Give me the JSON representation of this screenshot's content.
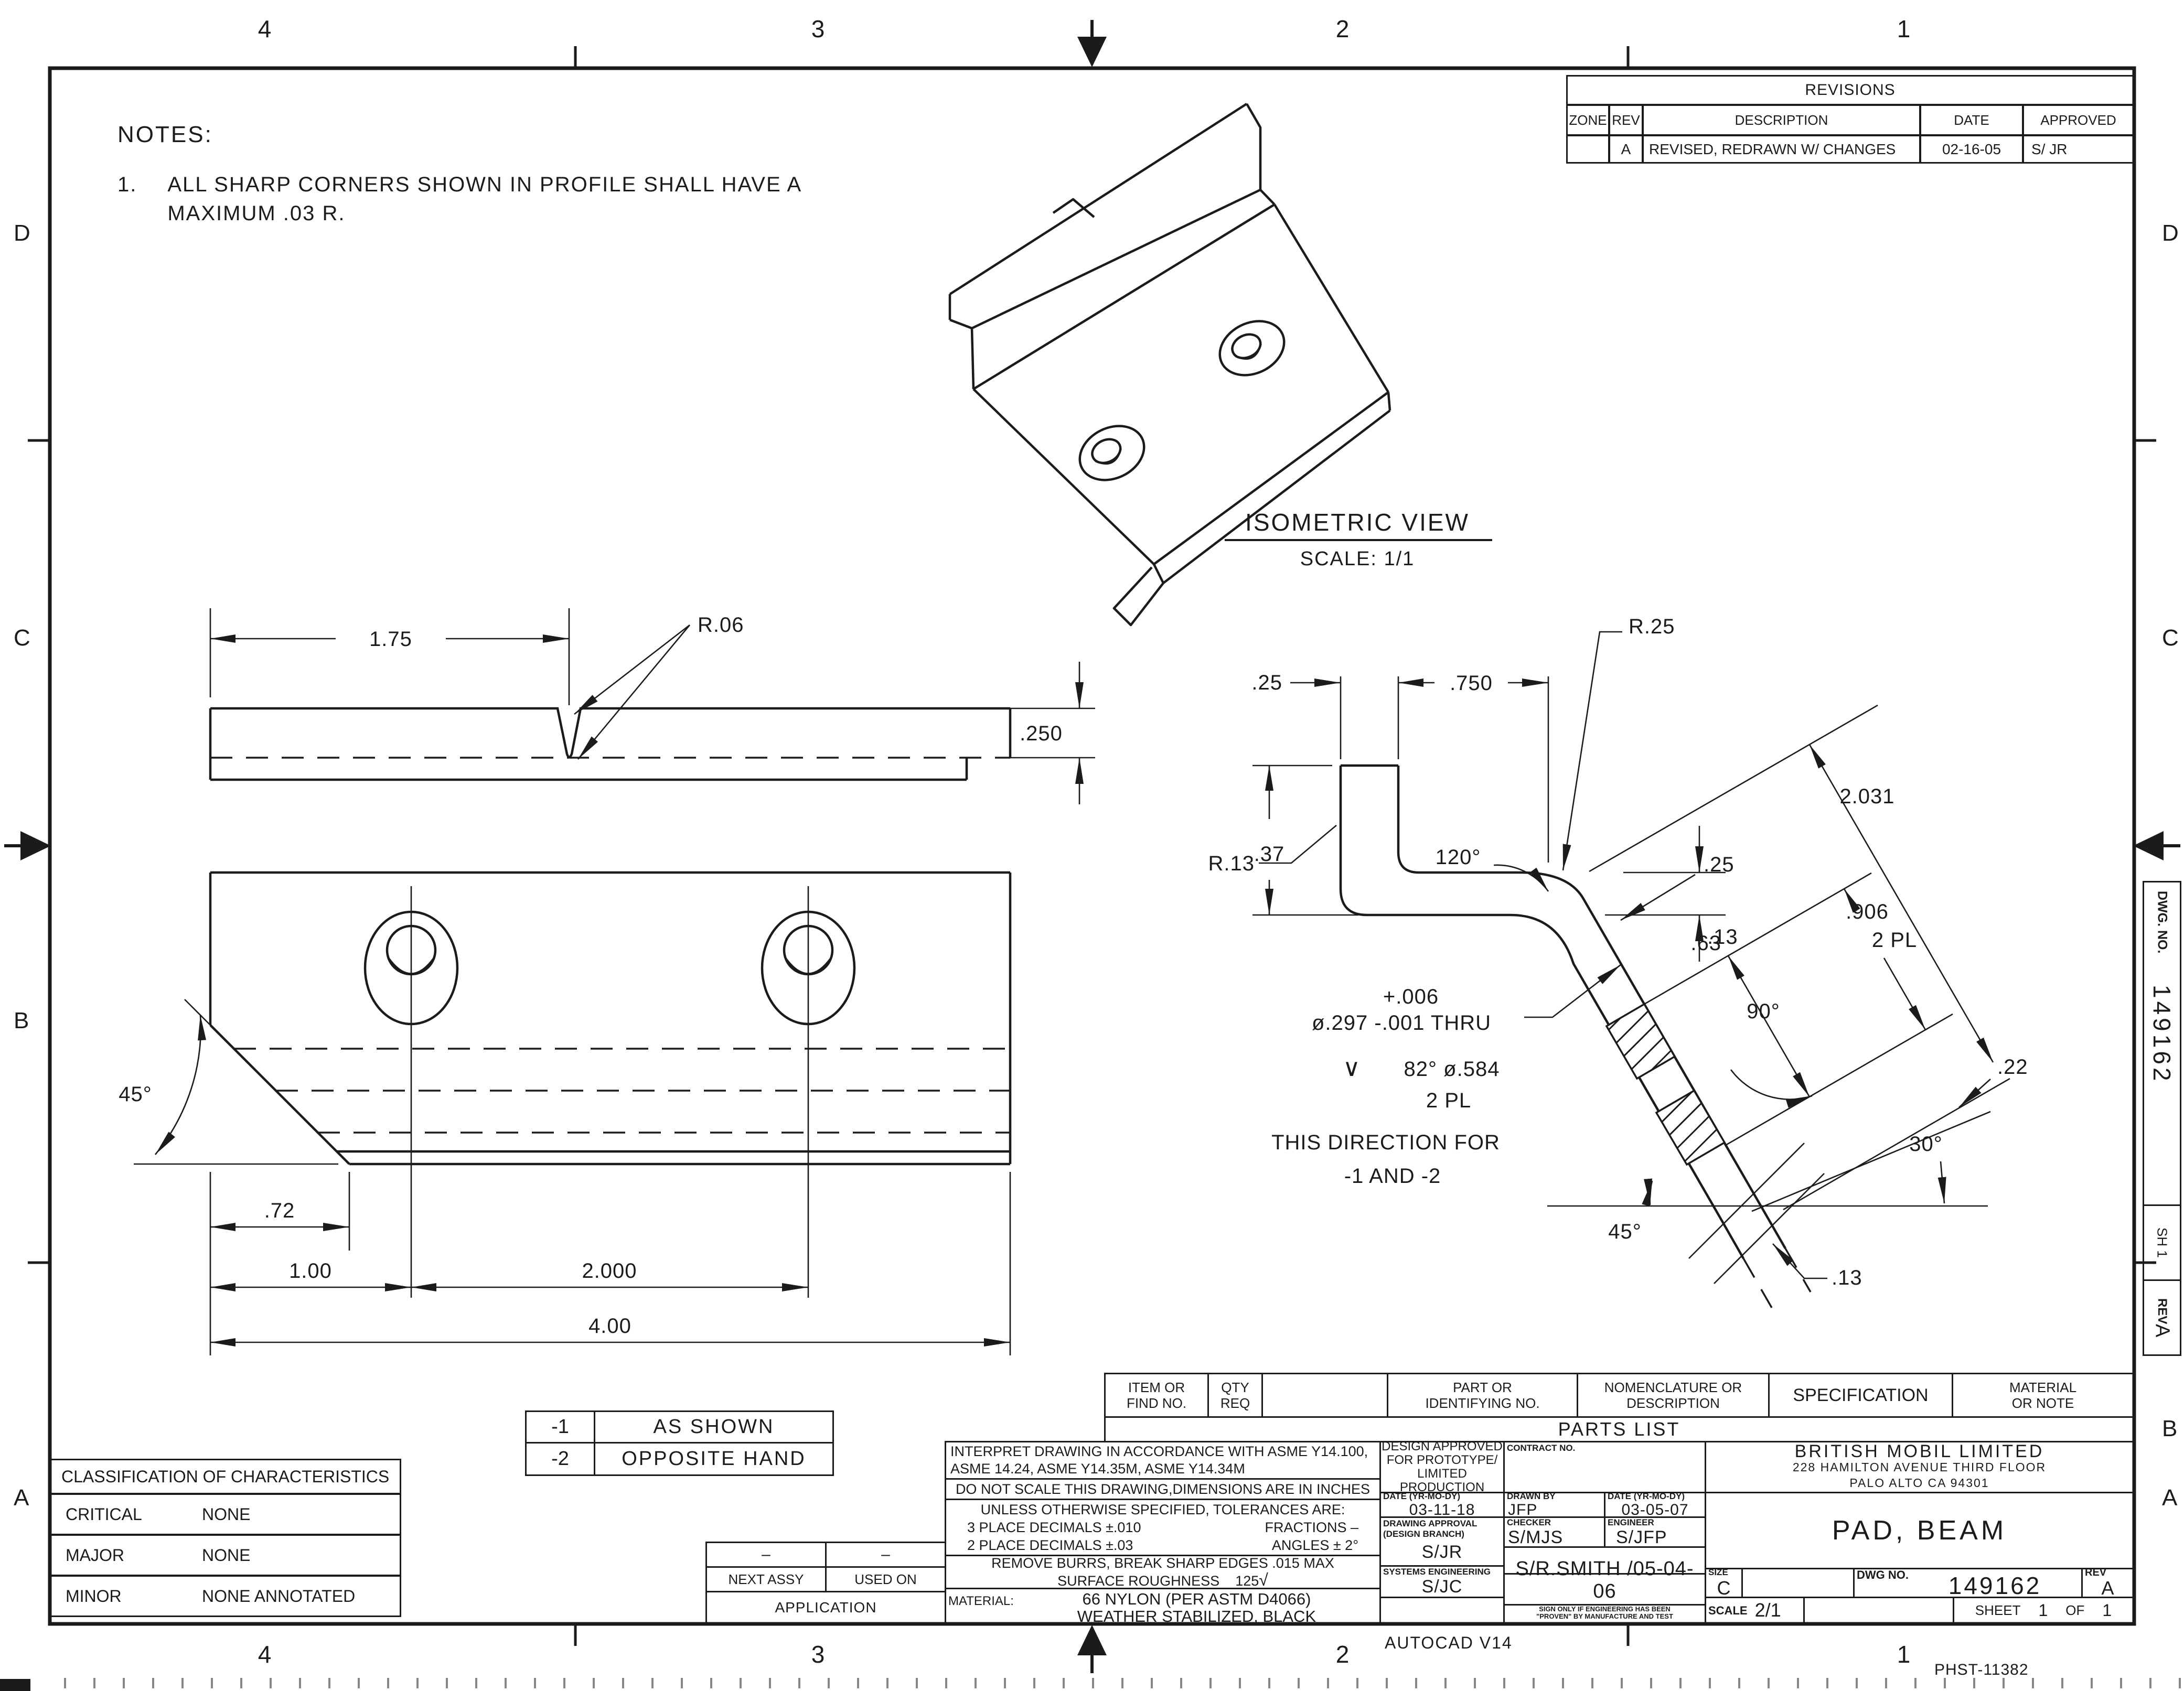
{
  "sheet": {
    "zones_top": [
      "4",
      "3",
      "2",
      "1"
    ],
    "zones_bottom": [
      "4",
      "3",
      "2",
      "1"
    ],
    "zones_left": [
      "D",
      "C",
      "B",
      "A"
    ],
    "zones_right": [
      "D",
      "C",
      "B",
      "A"
    ]
  },
  "notes": {
    "title": "NOTES:",
    "n1_no": "1.",
    "n1_line1": "ALL SHARP CORNERS SHOWN IN PROFILE SHALL HAVE A",
    "n1_line2": "MAXIMUM .03 R."
  },
  "revisions": {
    "title": "REVISIONS",
    "h_zone": "ZONE",
    "h_rev": "REV",
    "h_desc": "DESCRIPTION",
    "h_date": "DATE",
    "h_appr": "APPROVED",
    "r_zone": "",
    "r_rev": "A",
    "r_desc": "REVISED, REDRAWN W/ CHANGES",
    "r_date": "02-16-05",
    "r_appr": "S/ JR"
  },
  "iso": {
    "title": "ISOMETRIC VIEW",
    "scale": "SCALE: 1/1"
  },
  "dims": {
    "d175": "1.75",
    "r06": "R.06",
    "d250": ".250",
    "a45l": "45°",
    "d72": ".72",
    "d100": "1.00",
    "d2000": "2.000",
    "d400": "4.00",
    "d25": ".25",
    "d750": ".750",
    "r25": "R.25",
    "d37": ".37",
    "d13w": ".13",
    "r13": "R.13",
    "a120": "120°",
    "d25s": ".25",
    "d2031": "2.031",
    "d906": ".906",
    "pl2a": "2 PL",
    "d63": ".63",
    "a90": "90°",
    "d22": ".22",
    "a30": "30°",
    "a45r": "45°",
    "d13t": ".13",
    "holeTol": "+.006",
    "holeLine": "ø.297 -.001 THRU",
    "csink_sym": "∨",
    "csink": "82°  ø.584",
    "csinkPl": "2 PL",
    "dir1": "THIS DIRECTION FOR",
    "dir2": "-1 AND -2"
  },
  "variants": {
    "v1": "-1",
    "v1d": "AS SHOWN",
    "v2": "-2",
    "v2d": "OPPOSITE HAND"
  },
  "classification": {
    "title": "CLASSIFICATION OF CHARACTERISTICS",
    "c1": "CRITICAL",
    "c1v": "NONE",
    "c2": "MAJOR",
    "c2v": "NONE",
    "c3": "MINOR",
    "c3v": "NONE ANNOTATED"
  },
  "parts": {
    "h1a": "ITEM OR",
    "h1b": "FIND NO.",
    "h2a": "QTY",
    "h2b": "REQ",
    "h3a": "PART OR",
    "h3b": "IDENTIFYING NO.",
    "h4a": "NOMENCLATURE OR",
    "h4b": "DESCRIPTION",
    "h5": "SPECIFICATION",
    "h6a": "MATERIAL",
    "h6b": "OR NOTE",
    "title": "PARTS LIST"
  },
  "tb": {
    "interpret1": "INTERPRET DRAWING IN ACCORDANCE WITH ASME Y14.100,",
    "interpret2": "ASME 14.24, ASME Y14.35M, ASME Y14.34M",
    "dns": "DO NOT SCALE THIS DRAWING,DIMENSIONS ARE IN INCHES",
    "tol_t": "UNLESS OTHERWISE SPECIFIED, TOLERANCES ARE:",
    "tol3": "3 PLACE DECIMALS ±.010",
    "tolf": "FRACTIONS  –",
    "tol2": "2 PLACE DECIMALS ±.03",
    "tola": "ANGLES ± 2°",
    "burrs": "REMOVE BURRS, BREAK SHARP EDGES .015 MAX",
    "surf_l": "SURFACE ROUGHNESS",
    "surf_v": "125",
    "surf_sym": "√",
    "dash1": "–",
    "dash2": "–",
    "next": "NEXT ASSY",
    "used": "USED ON",
    "app": "APPLICATION",
    "mat_l": "MATERIAL:",
    "mat1": "66 NYLON  (PER ASTM D4066)",
    "mat2": "WEATHER STABILIZED, BLACK",
    "da1": "DESIGN APPROVED",
    "da2": "FOR PROTOTYPE/",
    "da3": "LIMITED",
    "da4": "PRODUCTION",
    "contract": "CONTRACT NO.",
    "datel1": "DATE (YR-MO-DY)",
    "date1": "03-11-18",
    "drawnl": "DRAWN BY",
    "drawn": "JFP",
    "datel2": "DATE (YR-MO-DY)",
    "date2": "03-05-07",
    "dal1": "DRAWING APPROVAL",
    "dal2": "(DESIGN BRANCH)",
    "dav": "S/JR",
    "chkl": "CHECKER",
    "chk": "S/MJS",
    "engl": "ENGINEER",
    "eng": "S/JFP",
    "sysl": "SYSTEMS ENGINEERING",
    "sys": "S/JC",
    "sig": "S/R.SMITH",
    "sigdate": "/05-04-06",
    "note1": "SIGN ONLY IF ENGINEERING HAS BEEN",
    "note2": "\"PROVEN\" BY MANUFACTURE AND TEST",
    "co": "BRITISH MOBIL LIMITED",
    "ad1": "228 HAMILTON AVENUE THIRD FLOOR",
    "ad2": "PALO ALTO CA 94301",
    "part": "PAD, BEAM",
    "sizel": "SIZE",
    "size": "C",
    "dwgl": "DWG NO.",
    "dwg": "149162",
    "revl": "REV",
    "rev": "A",
    "scalel": "SCALE",
    "scale": "2/1",
    "sheetl": "SHEET",
    "sheet1": "1",
    "ofl": "OF",
    "sheetN": "1"
  },
  "edge": {
    "dwgl": "DWG. NO.",
    "dwg": "149162",
    "sh": "SH 1",
    "revl": "REV",
    "rev": "A"
  },
  "footer": {
    "autocad": "AUTOCAD V14",
    "doc": "PHST-11382"
  }
}
